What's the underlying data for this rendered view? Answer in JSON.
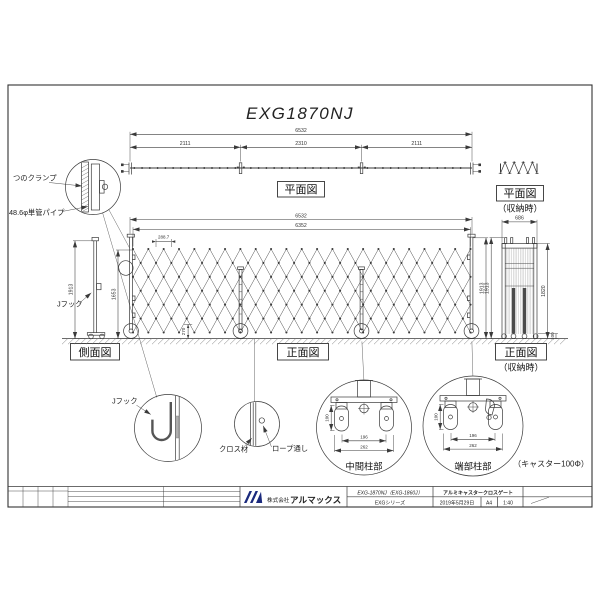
{
  "sheet": {
    "title": "EXG1870NJ"
  },
  "views": {
    "plan": {
      "label": "平面図"
    },
    "plan_stored": {
      "label": "平面図",
      "sub": "（収納時）"
    },
    "side": {
      "label": "側面図"
    },
    "front": {
      "label": "正面図"
    },
    "front_stored": {
      "label": "正面図",
      "sub": "（収納時）"
    }
  },
  "callouts": {
    "clamp": "つのクランプ",
    "pipe": "48.6φ単管パイプ",
    "j_hook": "Jフック",
    "j_hook_detail": "Jフック",
    "cross_member": "クロス材",
    "rope_pass": "ロープ通し",
    "mid_post": "中間柱部",
    "end_post": "端部柱部",
    "caster_note": "（キャスター100Φ）"
  },
  "dims": {
    "total_width": "6532",
    "segment_side": "2111",
    "segment_center": "2310",
    "inner_width": "6352",
    "pitch": "288.7",
    "panel_height": "1653",
    "post_height": "1913",
    "bottom_clearance": "270",
    "stored_width": "686",
    "stored_panel_height": "1820",
    "caster_diameter": "100",
    "wheel_spacing_inner": "196",
    "wheel_spacing_outer": "262"
  },
  "title_block": {
    "company_prefix": "株式会社",
    "company": "アルマックス",
    "model": "EXG-1870NJ（EXG-1860J）",
    "series": "EXGシリーズ",
    "product": "アルミキャスタークロスゲート",
    "date": "2019年5月29日",
    "scale_paper": "A4",
    "scale_ratio": "1:40"
  },
  "colors": {
    "line": "#3a3a3a",
    "accent": "#1b2a7d"
  }
}
